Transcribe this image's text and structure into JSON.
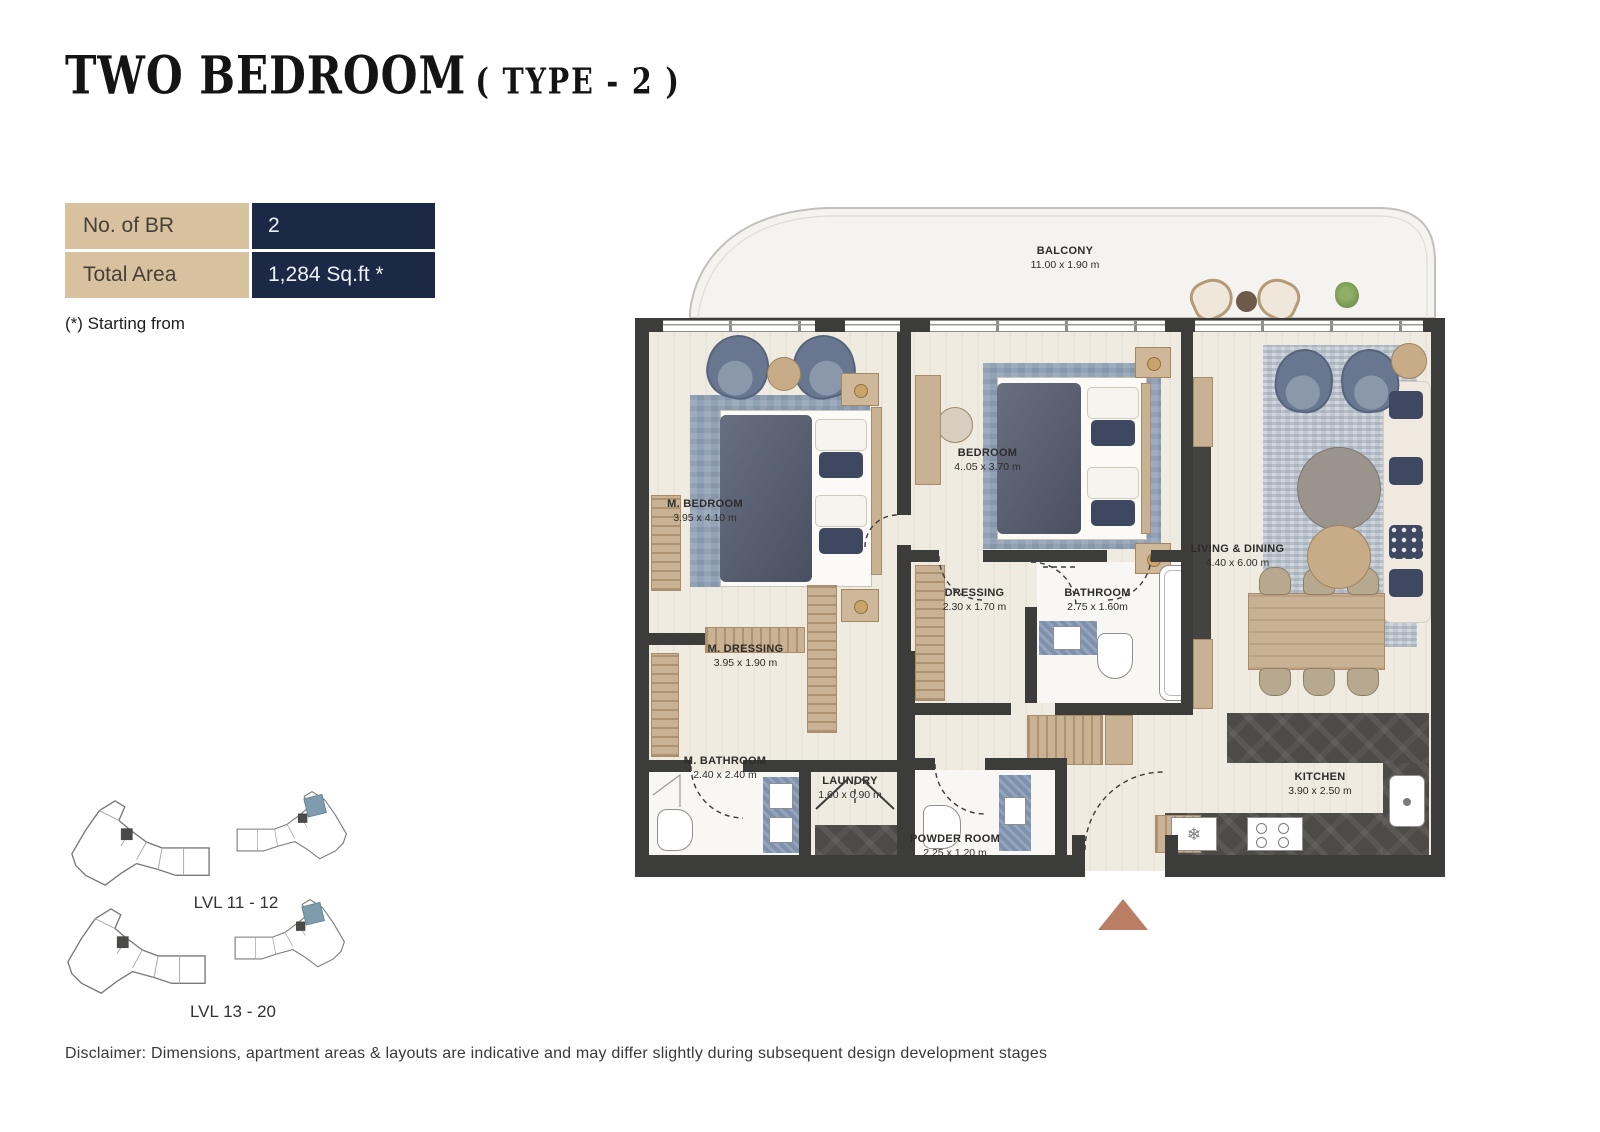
{
  "title": {
    "main": "TWO BEDROOM",
    "suffix": "( TYPE - 2 )"
  },
  "spec_table": {
    "rows": [
      {
        "label": "No. of BR",
        "value": "2"
      },
      {
        "label": "Total Area",
        "value": "1,284 Sq.ft *"
      }
    ],
    "note": "(*) Starting from"
  },
  "plan": {
    "rooms": [
      {
        "name": "BALCONY",
        "dims": "11.00 x 1.90 m"
      },
      {
        "name": "M. BEDROOM",
        "dims": "3.95 x 4.10 m"
      },
      {
        "name": "BEDROOM",
        "dims": "4..05 x 3.70 m"
      },
      {
        "name": "LIVING & DINING",
        "dims": "4.40 x 6.00 m"
      },
      {
        "name": "M. DRESSING",
        "dims": "3.95 x 1.90 m"
      },
      {
        "name": "DRESSING",
        "dims": "2.30 x 1.70 m"
      },
      {
        "name": "BATHROOM",
        "dims": "2.75 x 1.60m"
      },
      {
        "name": "M. BATHROOM",
        "dims": "2.40 x 2.40 m"
      },
      {
        "name": "LAUNDRY",
        "dims": "1.60 x 0.90 m"
      },
      {
        "name": "POWDER ROOM",
        "dims": "2.25 x 1.20 m"
      },
      {
        "name": "KITCHEN",
        "dims": "3.90 x 2.50 m"
      }
    ]
  },
  "keyplans": [
    {
      "label": "LVL 11 - 12"
    },
    {
      "label": "LVL 13 - 20"
    }
  ],
  "disclaimer": "Disclaimer: Dimensions, apartment areas & layouts are indicative and may differ slightly during subsequent design development stages",
  "colors": {
    "navy": "#1b2946",
    "tan": "#d8c19e",
    "wall": "#3c3c3a",
    "floor": "#f0ebe1",
    "rug_blue": "#93a3b6",
    "rug_living": "#c0c9d1",
    "furniture_blue": "#68778f",
    "wood": "#c9b294",
    "tile_blue": "#7d90ad",
    "counter_dark": "#4c4b47",
    "entrance_arrow": "#ba7e65",
    "keyplan_highlight": "#7e9cae"
  }
}
